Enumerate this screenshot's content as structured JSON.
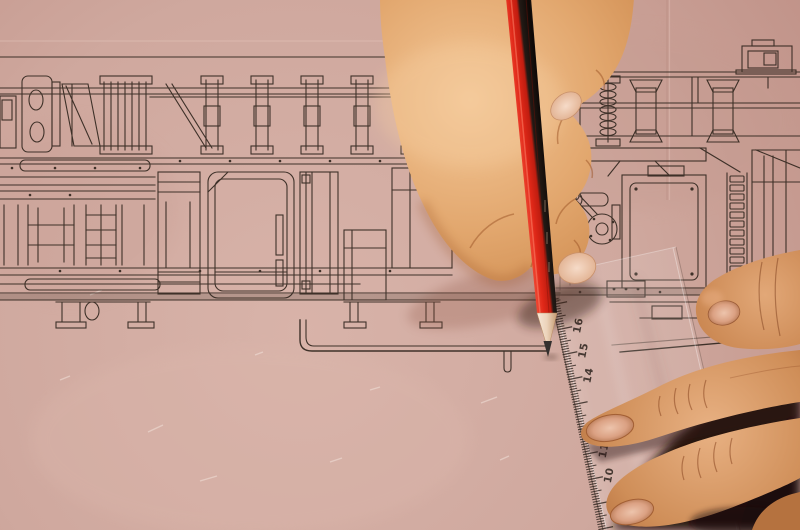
{
  "ruler": {
    "numbers": [
      "16",
      "15",
      "14",
      "11",
      "10"
    ]
  },
  "colors": {
    "paper": "#cfa9a0",
    "paper_light": "#d9b5ab",
    "paper_dark": "#c0968c",
    "drawing_ink": "#32271f",
    "pencil_red": "#d6301d",
    "pencil_black_stripe": "#1a130e",
    "pencil_wood": "#f0ddcb",
    "pencil_graphite": "#34302f",
    "ruler_tint": "rgba(255,255,255,0.14)",
    "ruler_markings": "#2c231d",
    "skin_highlight": "#f2c392",
    "skin_base": "#d9995f",
    "skin_shadow": "#9c5a2e",
    "left_hand_base": "#c07a45",
    "corner_shadow": "#200f08"
  }
}
